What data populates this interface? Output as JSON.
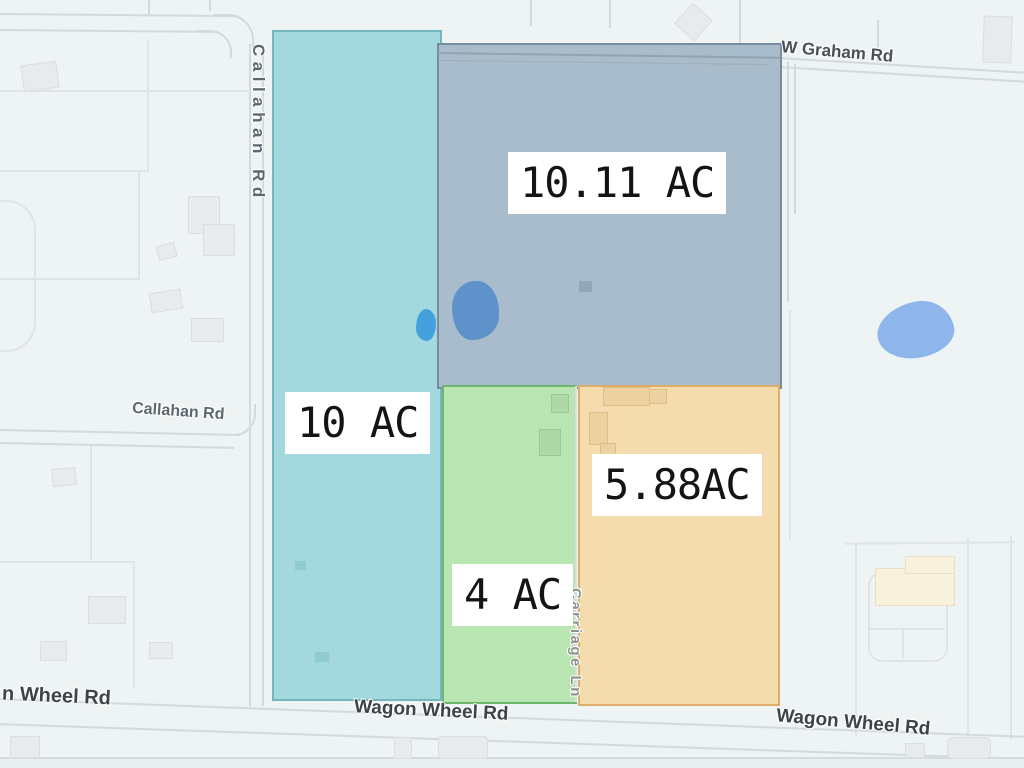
{
  "title": "Land parcels acreage map",
  "parcels": [
    {
      "name": "west",
      "area_label": "10 AC",
      "fill": "#a3d8de",
      "border": "rgba(80,156,166,0.55)"
    },
    {
      "name": "northeast",
      "area_label": "10.11 AC",
      "fill": "#a8bccb",
      "border": "rgba(106,126,146,0.75)"
    },
    {
      "name": "south_center",
      "area_label": "4 AC",
      "fill": "#b9e5b2",
      "border": "rgba(95,174,95,0.85)"
    },
    {
      "name": "southeast",
      "area_label": "5.88AC",
      "fill": "#f4dcae",
      "border": "rgba(216,165,94,0.85)"
    }
  ],
  "roads": {
    "callahan_vertical": "Callahan Rd",
    "callahan_horizontal": "Callahan Rd",
    "w_graham": "W Graham Rd",
    "carriage_ln": "Carriage Ln",
    "wagon_wheel_left": "n Wheel Rd",
    "wagon_wheel_center": "Wagon Wheel Rd",
    "wagon_wheel_right": "Wagon Wheel Rd"
  },
  "colors": {
    "background": "#eef3f4",
    "pond_small": "#45a1dd",
    "pond_medium": "#5f92cb",
    "pond_large": "#8fb6eb",
    "area_label_text": "#141414",
    "area_label_bg": "#ffffff"
  }
}
